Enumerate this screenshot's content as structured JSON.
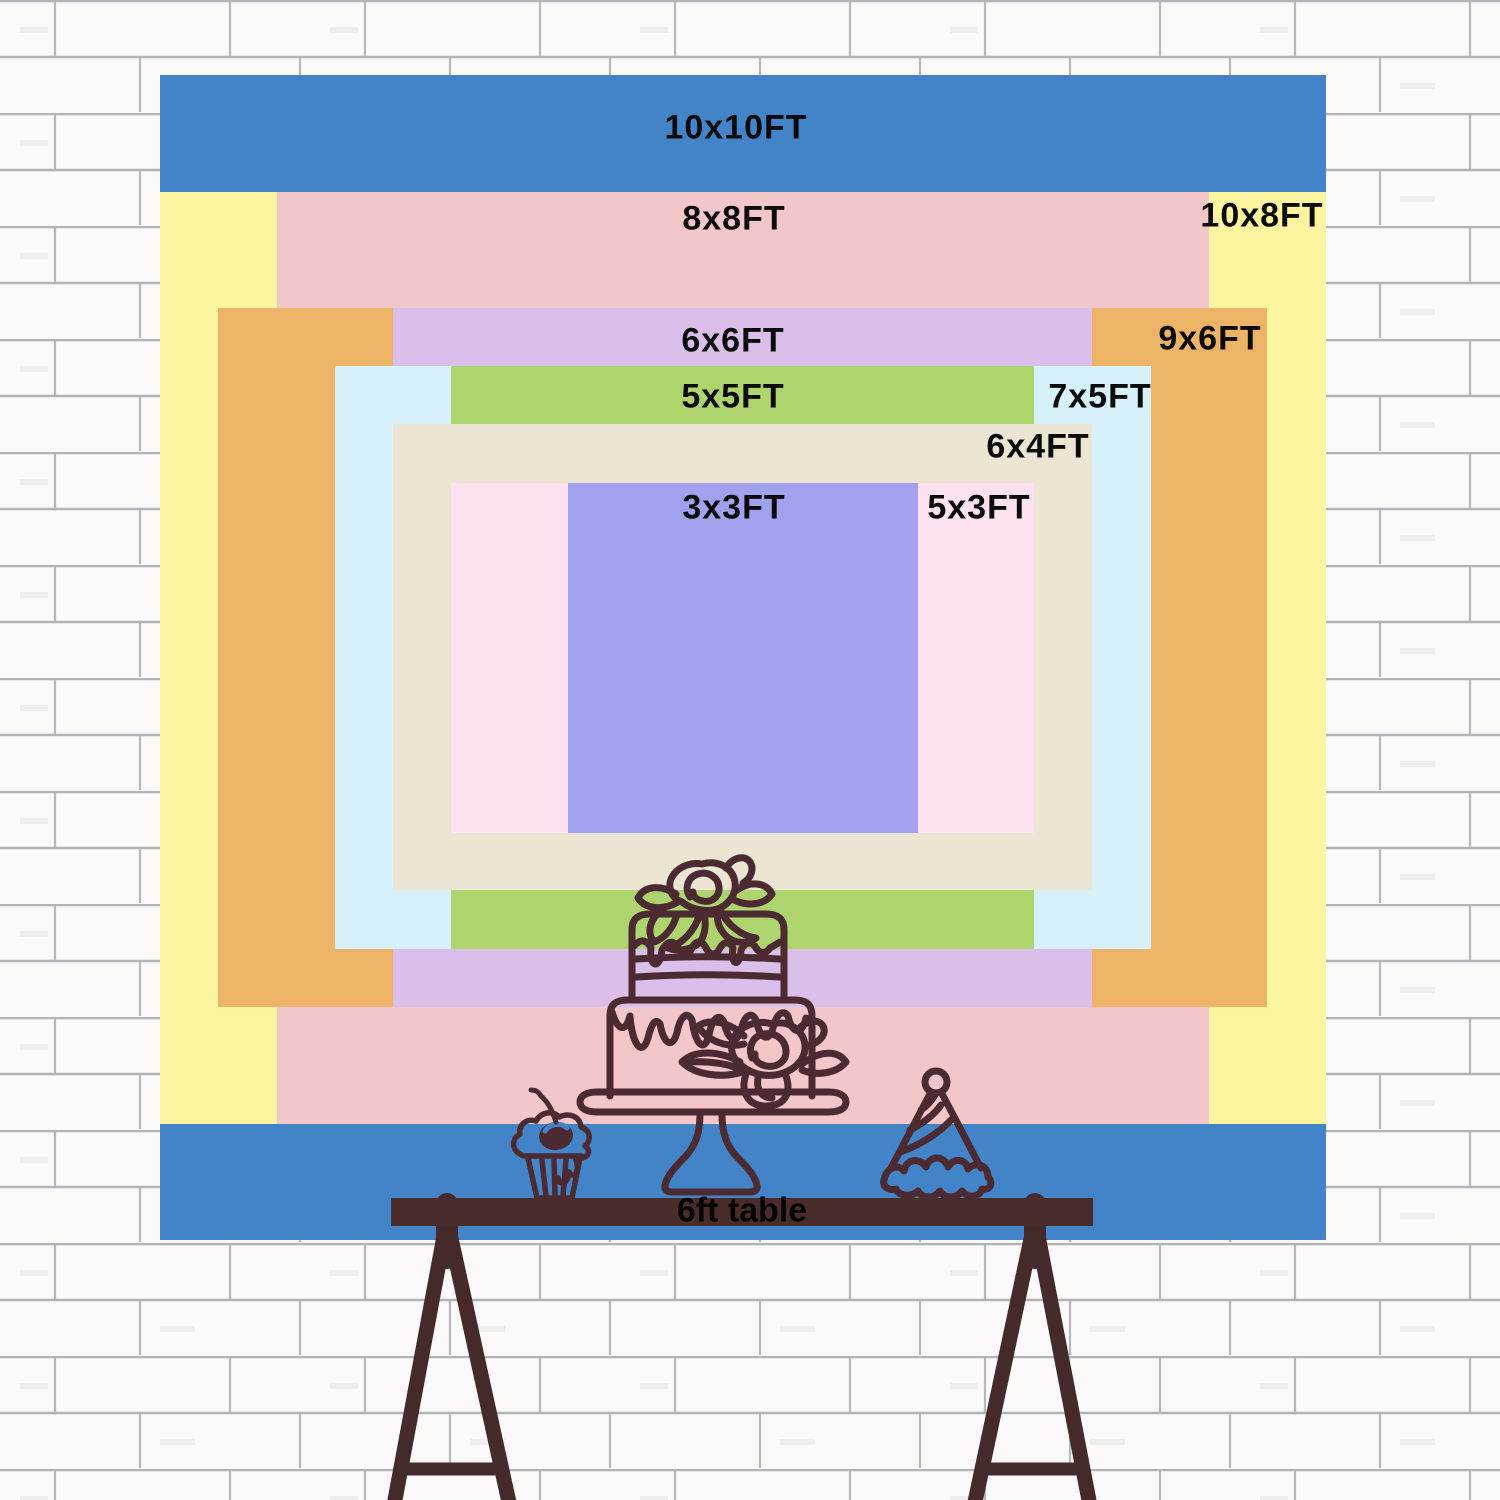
{
  "title": "Backdrop size comparison chart",
  "wall": {
    "style": "white painted brick wall",
    "brick_color": "#fbfaf8",
    "mortar_line_color": "#a6a6ae"
  },
  "backdrop": {
    "scale_px_per_ft": 116.5,
    "sizes": [
      {
        "label": "10x10FT",
        "width_ft": 10,
        "height_ft": 10,
        "color": "#4284c7"
      },
      {
        "label": "10x8FT",
        "width_ft": 10,
        "height_ft": 8,
        "color": "#fbf5a0"
      },
      {
        "label": "8x8FT",
        "width_ft": 8,
        "height_ft": 8,
        "color": "#f3c6c9"
      },
      {
        "label": "9x6FT",
        "width_ft": 9,
        "height_ft": 6,
        "color": "#edb367"
      },
      {
        "label": "6x6FT",
        "width_ft": 6,
        "height_ft": 6,
        "color": "#d9bfe9"
      },
      {
        "label": "7x5FT",
        "width_ft": 7,
        "height_ft": 5,
        "color": "#d6f1f9"
      },
      {
        "label": "5x5FT",
        "width_ft": 5,
        "height_ft": 5,
        "color": "#aed46e"
      },
      {
        "label": "6x4FT",
        "width_ft": 6,
        "height_ft": 4,
        "color": "#ece5d4"
      },
      {
        "label": "5x3FT",
        "width_ft": 5,
        "height_ft": 3,
        "color": "#fce2f1"
      },
      {
        "label": "3x3FT",
        "width_ft": 3,
        "height_ft": 3,
        "color": "#a0a2ed"
      }
    ]
  },
  "table": {
    "label": "6ft table",
    "top_color": "#4a2c2b",
    "leg_color": "#452a2c"
  },
  "decorations": {
    "line_color": "#4b2b31",
    "items": [
      "cupcake-icon",
      "tiered-cake-icon",
      "party-hat-icon"
    ]
  }
}
